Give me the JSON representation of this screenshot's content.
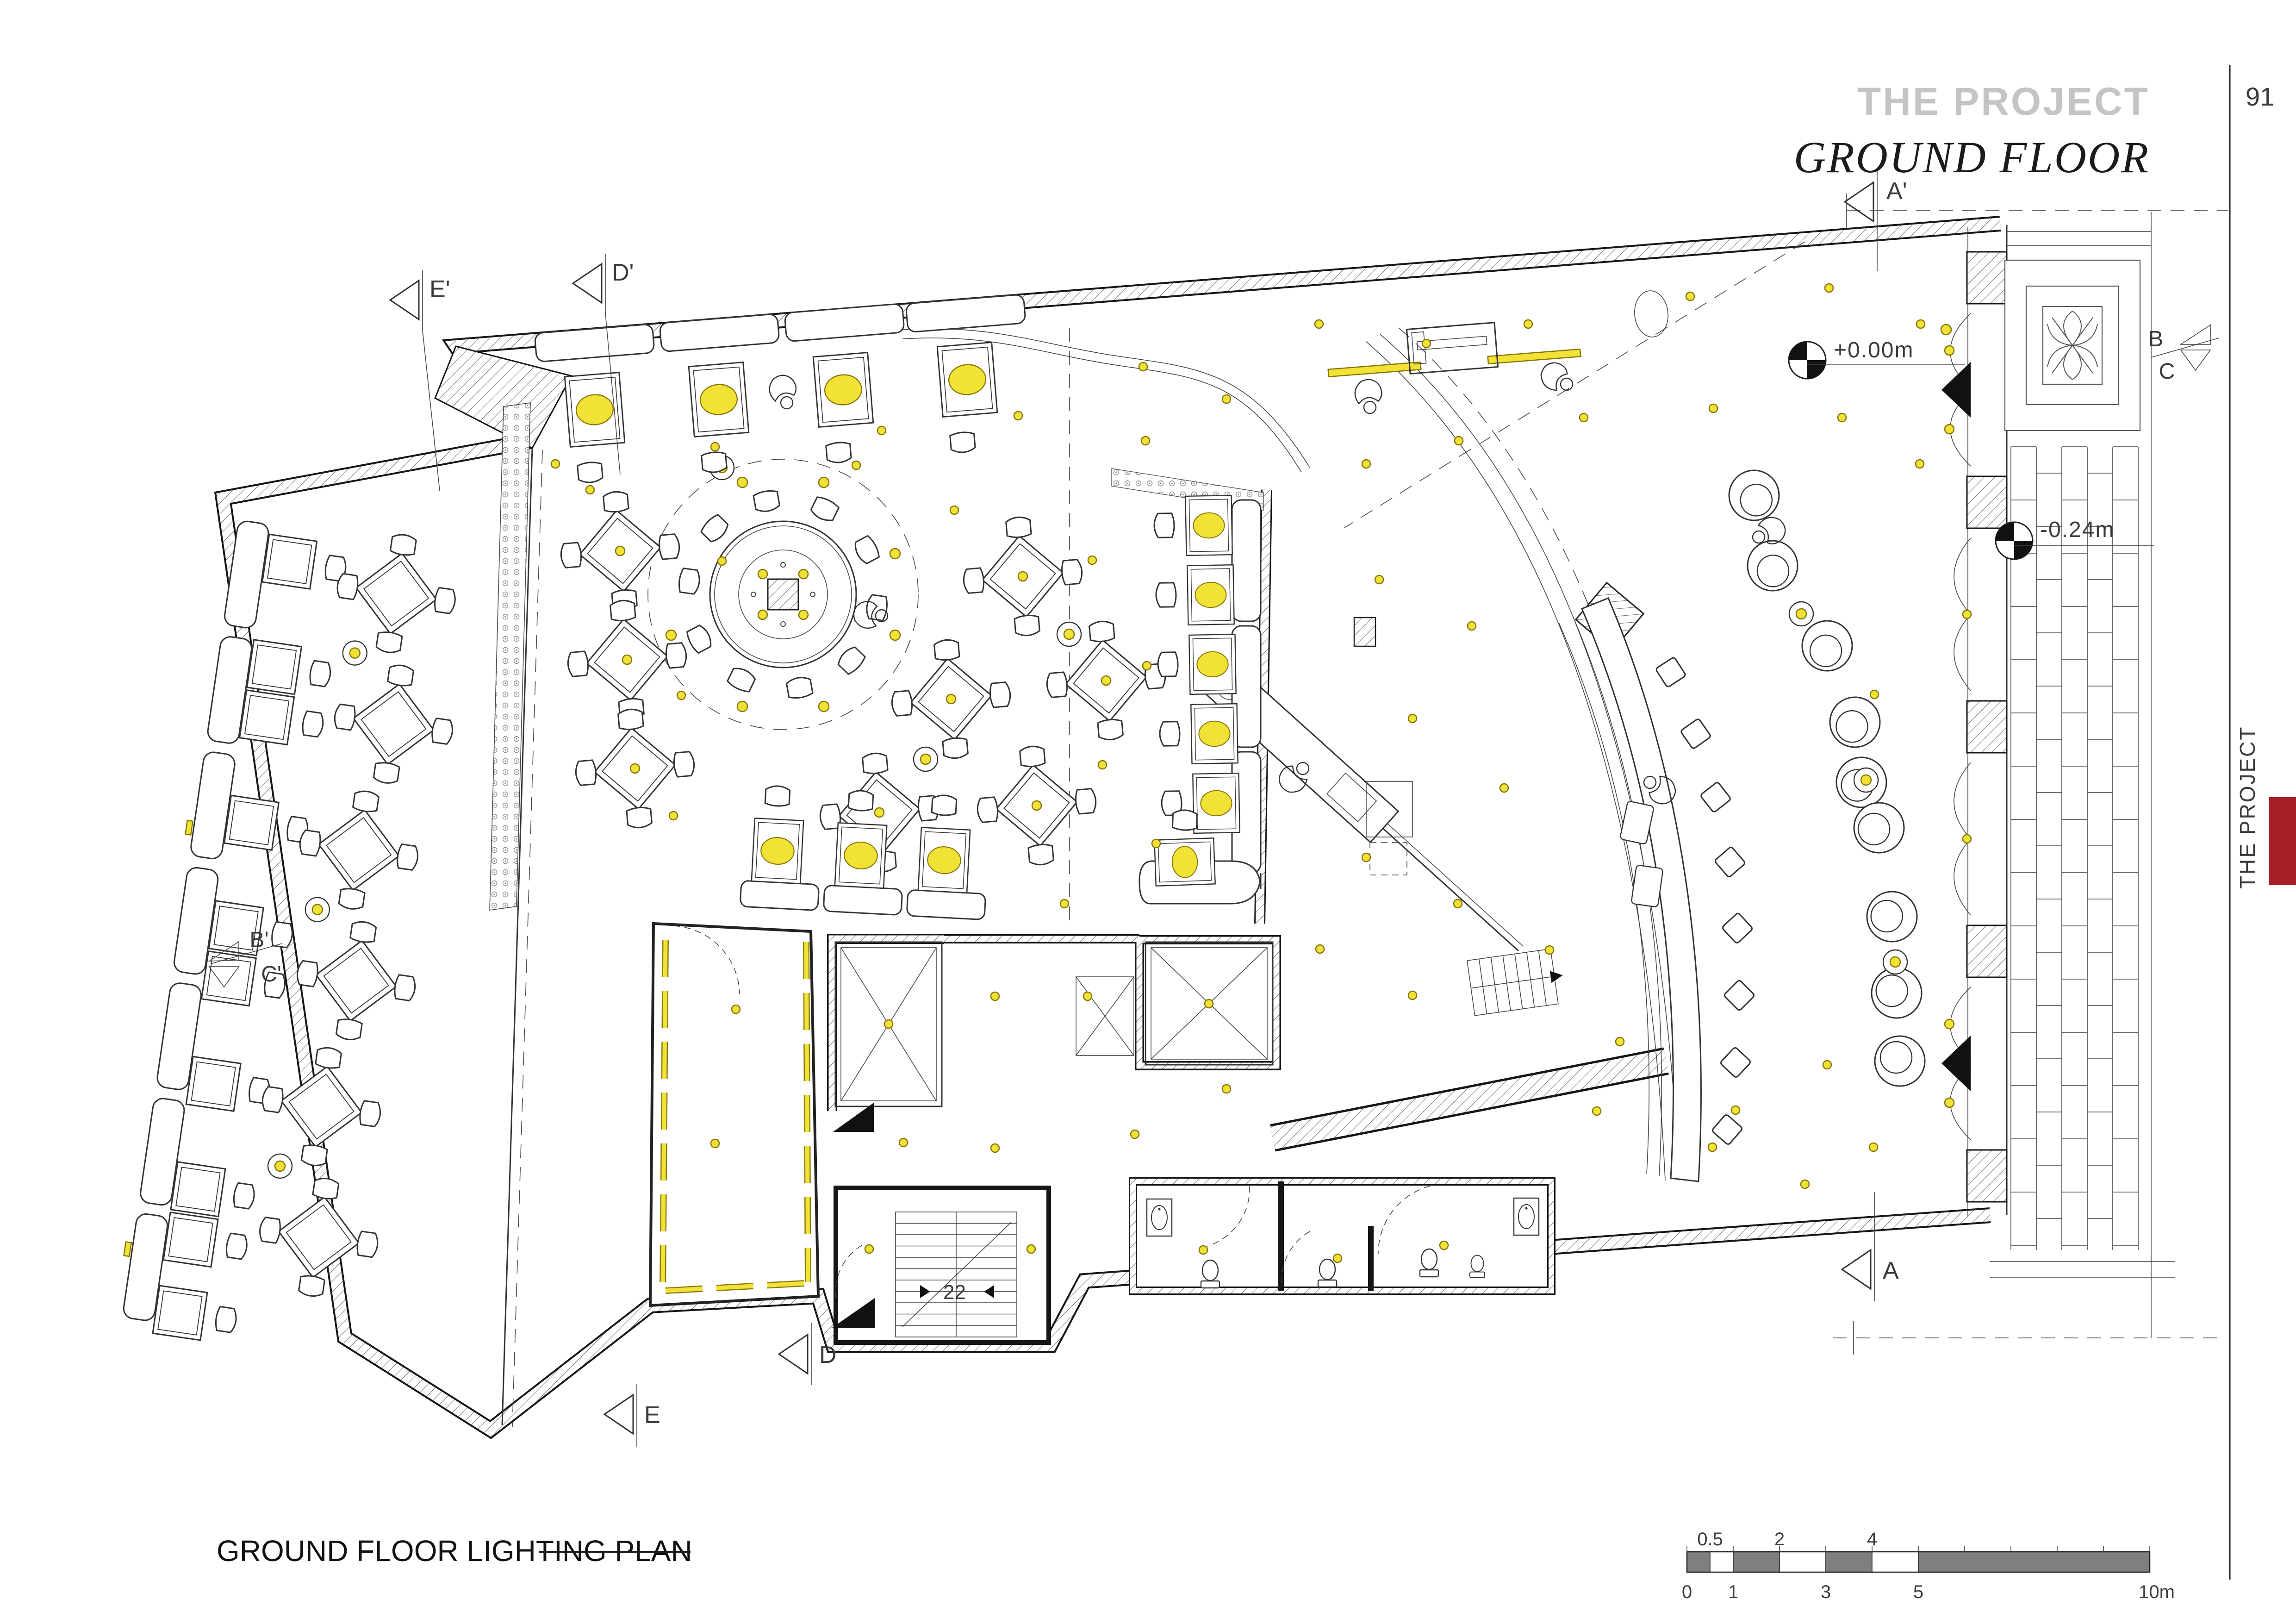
{
  "header": {
    "title": "THE PROJECT",
    "subtitle": "GROUND FLOOR",
    "page_number": "91"
  },
  "side_tab": {
    "label": "THE PROJECT"
  },
  "footer": {
    "plan_title": "GROUND FLOOR LIGHTING PLAN"
  },
  "scale_bar": {
    "labels_above": [
      "0.5",
      "2",
      "4"
    ],
    "labels_below": [
      "0",
      "1",
      "3",
      "5",
      "10m"
    ]
  },
  "levels": {
    "main": "+0.00m",
    "street": "-0.24m"
  },
  "markers": {
    "a_top": "A'",
    "d_top": "D'",
    "e_top": "E'",
    "b_right": "B",
    "c_right": "C",
    "b_left": "B'",
    "c_left": "C'",
    "a_bottom": "A",
    "d_bottom": "D",
    "e_bottom": "E"
  },
  "stairs": {
    "risers": "22"
  },
  "colors": {
    "line": "#333333",
    "hatch": "#666666",
    "light_fill": "#f2e236",
    "light_stroke": "#857607",
    "title_gray": "#c4c4c4",
    "side_text_gray": "#8d8d8d",
    "accent_red": "#a61f27",
    "scale_dark": "#7f7f7f"
  }
}
